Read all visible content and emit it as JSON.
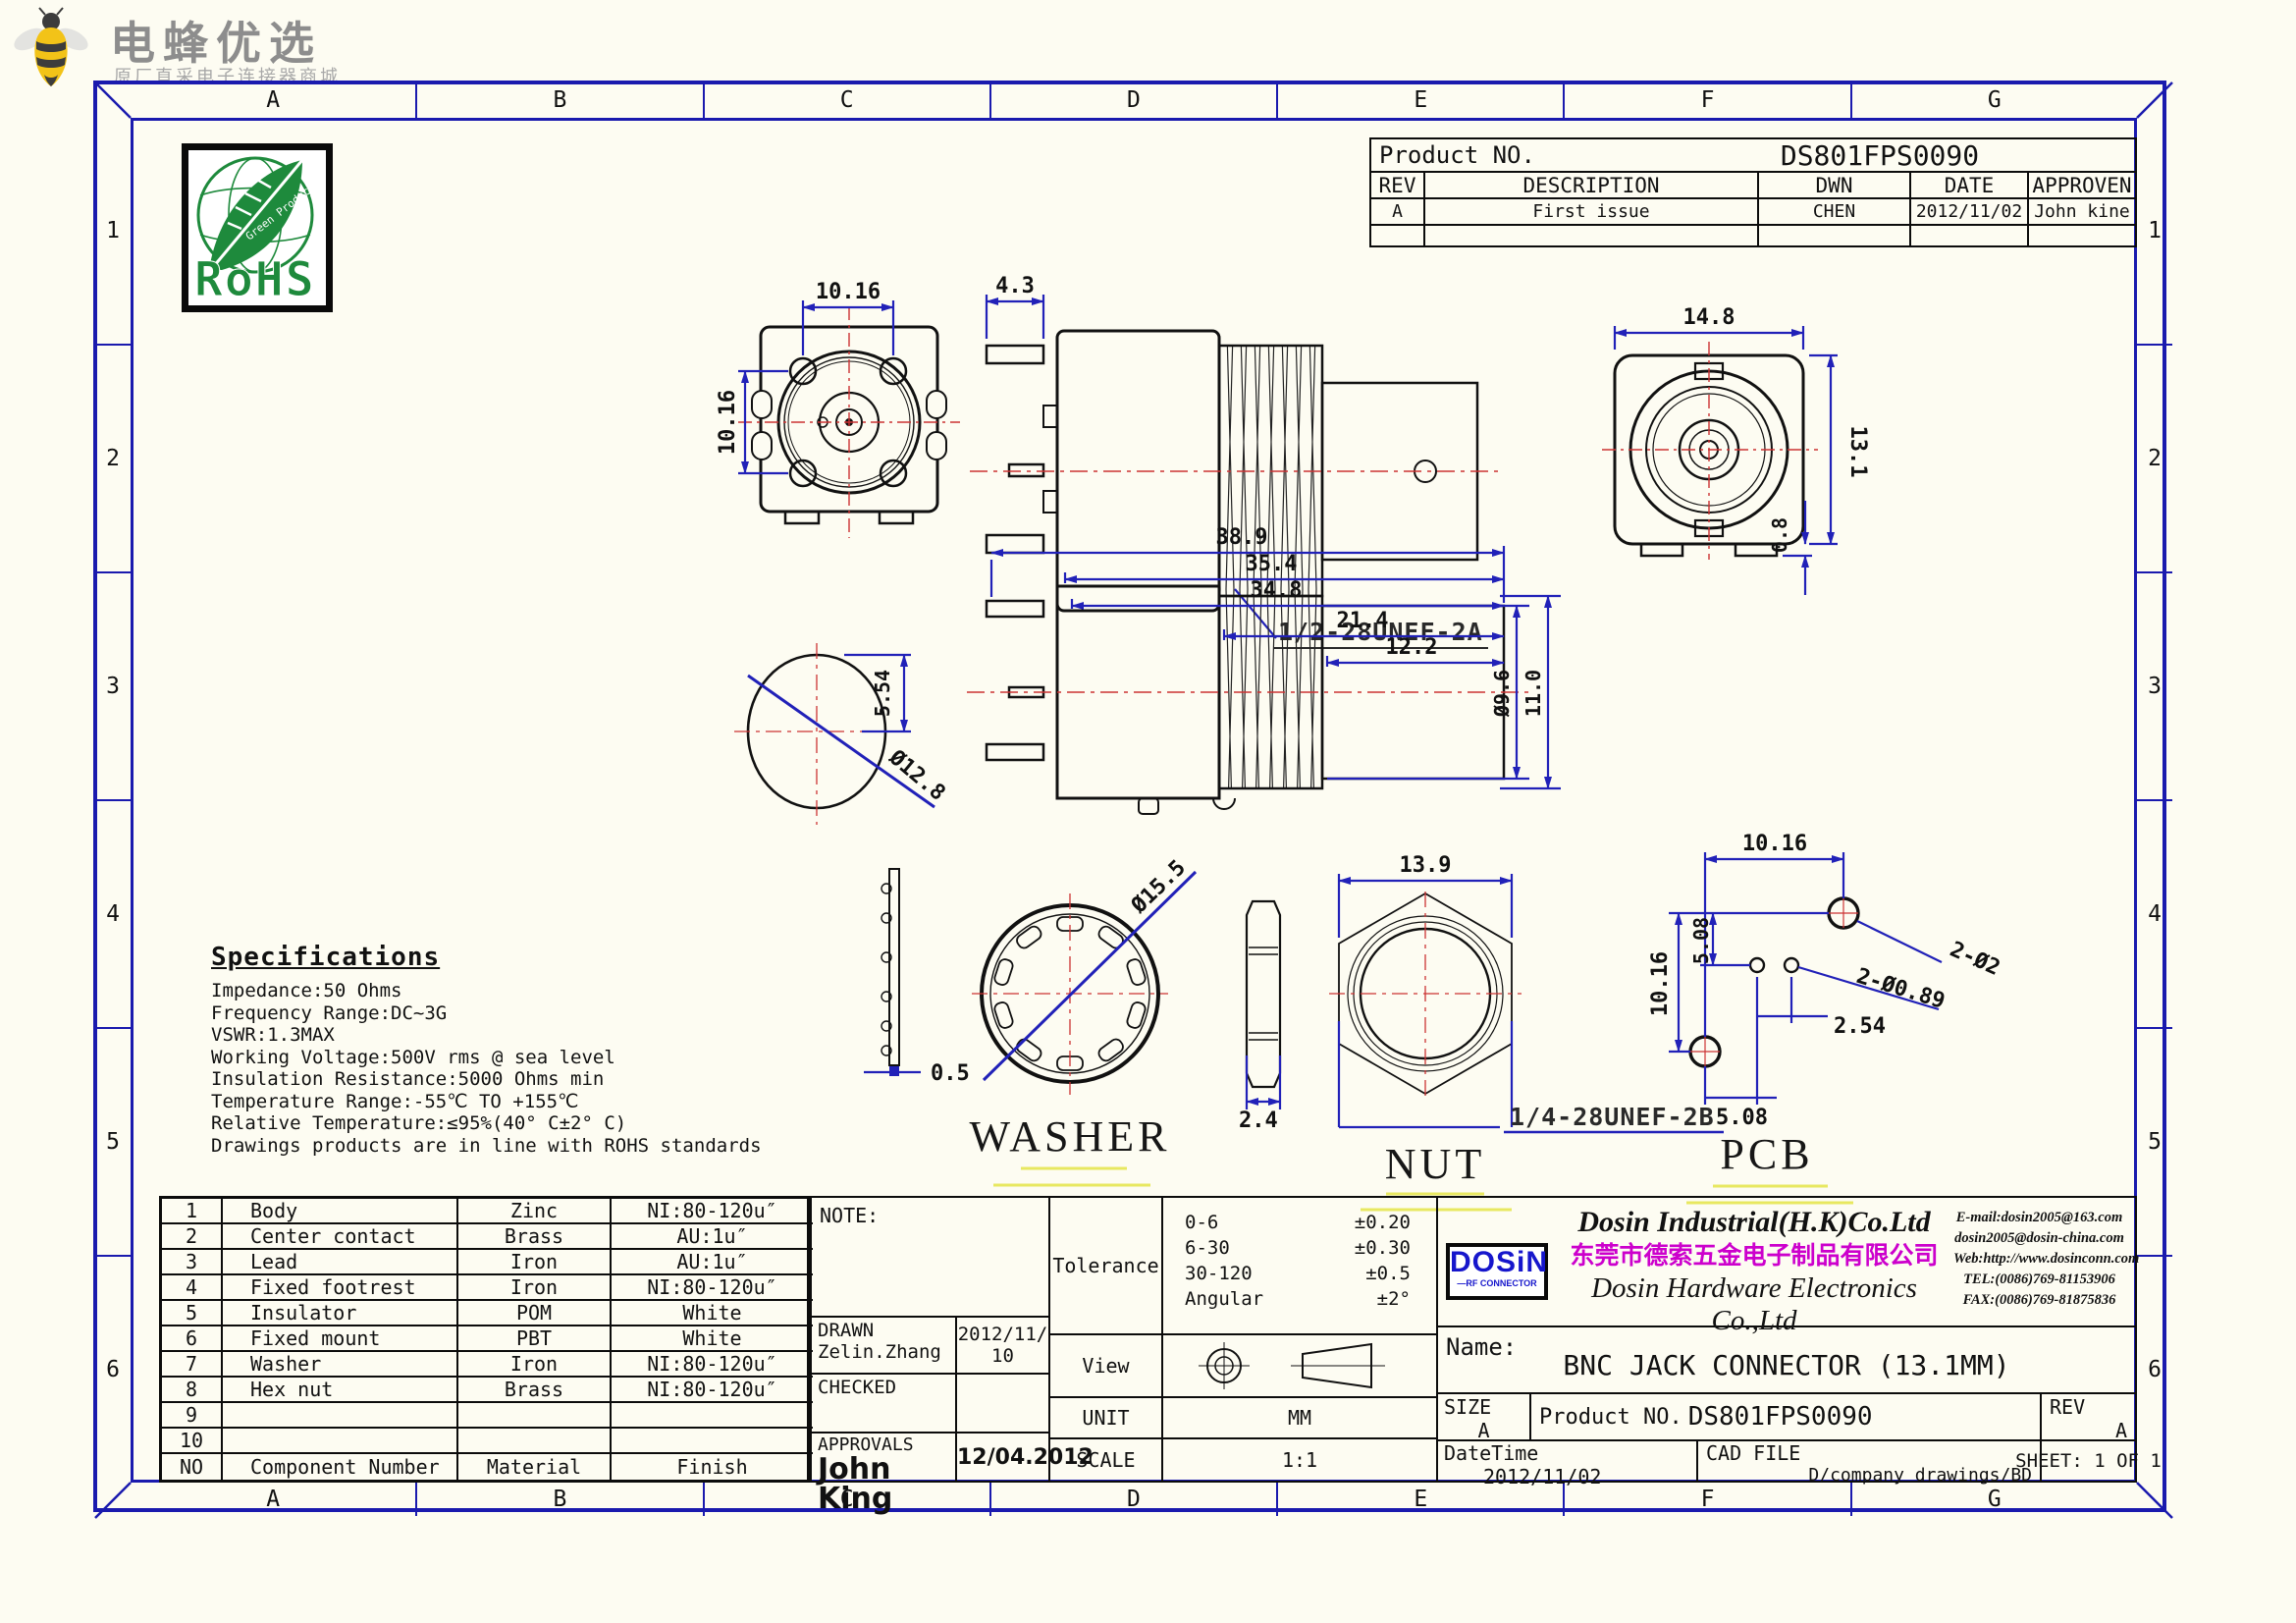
{
  "brand": {
    "title": "电蜂优选",
    "subtitle": "原厂直采电子连接器商城"
  },
  "frame": {
    "cols": [
      "A",
      "B",
      "C",
      "D",
      "E",
      "F",
      "G"
    ],
    "rows": [
      "1",
      "2",
      "3",
      "4",
      "5",
      "6"
    ]
  },
  "rohs": {
    "text": "RoHS",
    "subtext": "Green Product"
  },
  "header": {
    "product_no_label": "Product NO.",
    "product_no": "DS801FPS0090",
    "rev_headers": [
      "REV",
      "DESCRIPTION",
      "DWN",
      "DATE",
      "APPROVEN"
    ],
    "rev_row": {
      "rev": "A",
      "description": "First issue",
      "dwn": "CHEN",
      "date": "2012/11/02",
      "approven": "John kine"
    }
  },
  "specs": {
    "title": "Specifications",
    "lines": [
      "Impedance:50 Ohms",
      "Frequency Range:DC~3G",
      "VSWR:1.3MAX",
      "Working Voltage:500V rms @ sea level",
      "Insulation Resistance:5000 Ohms min",
      "Temperature Range:-55℃ TO +155℃",
      "Relative Temperature:≤95%(40° C±2° C)",
      "Drawings products are in line with ROHS standards"
    ]
  },
  "drawings": {
    "front": {
      "dim_top": "10.16",
      "dim_left": "10.16"
    },
    "side": {
      "dim_pin": "4.3",
      "thread": "1/2-28UNEF-2A"
    },
    "right": {
      "dim_w": "14.8",
      "dim_h": "13.1",
      "dim_tab": "0.8"
    },
    "section": {
      "d1": "38.9",
      "d2": "35.4",
      "d3": "34.8",
      "d4": "21.4",
      "d5": "12.2",
      "dia_rear": "Ø9.6",
      "h_rear": "11.0",
      "circle_dia": "Ø12.8",
      "circle_h": "5.54"
    },
    "washer": {
      "label": "WASHER",
      "thickness": "0.5",
      "diameter": "Ø15.5"
    },
    "nut": {
      "label": "NUT",
      "thickness": "2.4",
      "width": "13.9",
      "thread": "1/4-28UNEF-2B"
    },
    "pcb": {
      "label": "PCB",
      "dim_top": "10.16",
      "dim_left": "10.16",
      "dim_up": "5.08",
      "dim_bottom": "5.08",
      "dim_pitch": "2.54",
      "holes_big": "2-Ø2",
      "holes_small": "2-Ø0.89"
    }
  },
  "parts": {
    "headers": {
      "no": "NO",
      "component": "Component Number",
      "material": "Material",
      "finish": "Finish"
    },
    "rows": [
      {
        "no": "1",
        "component": "Body",
        "material": "Zinc",
        "finish": "NI:80-120u″"
      },
      {
        "no": "2",
        "component": "Center contact",
        "material": "Brass",
        "finish": "AU:1u″"
      },
      {
        "no": "3",
        "component": "Lead",
        "material": "Iron",
        "finish": "AU:1u″"
      },
      {
        "no": "4",
        "component": "Fixed footrest",
        "material": "Iron",
        "finish": "NI:80-120u″"
      },
      {
        "no": "5",
        "component": "Insulator",
        "material": "POM",
        "finish": "White"
      },
      {
        "no": "6",
        "component": "Fixed mount",
        "material": "PBT",
        "finish": "White"
      },
      {
        "no": "7",
        "component": "Washer",
        "material": "Iron",
        "finish": "NI:80-120u″"
      },
      {
        "no": "8",
        "component": "Hex nut",
        "material": "Brass",
        "finish": "NI:80-120u″"
      },
      {
        "no": "9",
        "component": "",
        "material": "",
        "finish": ""
      },
      {
        "no": "10",
        "component": "",
        "material": "",
        "finish": ""
      }
    ]
  },
  "titleblock": {
    "note_label": "NOTE:",
    "drawn_label": "DRAWN",
    "drawn_name": "Zelin.Zhang",
    "drawn_date": "2012/11/10",
    "checked_label": "CHECKED",
    "approvals_label": "APPROVALS",
    "approvals_sign": "John King",
    "approvals_date": "12/04.2012",
    "tolerance_label": "Tolerance",
    "tolerance_rows": [
      {
        "range": "0-6",
        "value": "±0.20"
      },
      {
        "range": "6-30",
        "value": "±0.30"
      },
      {
        "range": "30-120",
        "value": "±0.5"
      },
      {
        "range": "Angular",
        "value": "±2°"
      }
    ],
    "view_label": "View",
    "unit_label": "UNIT",
    "unit_value": "MM",
    "scale_label": "SCALE",
    "scale_value": "1:1"
  },
  "company": {
    "logo_text": "DOSiN",
    "logo_sub": "—RF CONNECTOR",
    "name_en1": "Dosin Industrial(H.K)Co.Ltd",
    "name_cn": "东莞市德索五金电子制品有限公司",
    "name_en2": "Dosin Hardware Electronics Co.,Ltd",
    "contact_lines": [
      "E-mail:dosin2005@163.com",
      "dosin2005@dosin-china.com",
      "Web:http://www.dosinconn.com",
      "TEL:(0086)769-81153906",
      "FAX:(0086)769-81875836"
    ],
    "name_label": "Name:",
    "product_name": "BNC  JACK CONNECTOR (13.1MM)",
    "size_label": "SIZE",
    "size_value": "A",
    "product_no_label": "Product NO.",
    "product_no": "DS801FPS0090",
    "rev_label": "REV",
    "rev_value": "A",
    "datetime_label": "DateTime",
    "datetime_value": "2012/11/02",
    "cadfile_label": "CAD FILE",
    "cadfile_value": "D/company drawings/BD",
    "sheet_label": "SHEET:  1 OF 1"
  }
}
